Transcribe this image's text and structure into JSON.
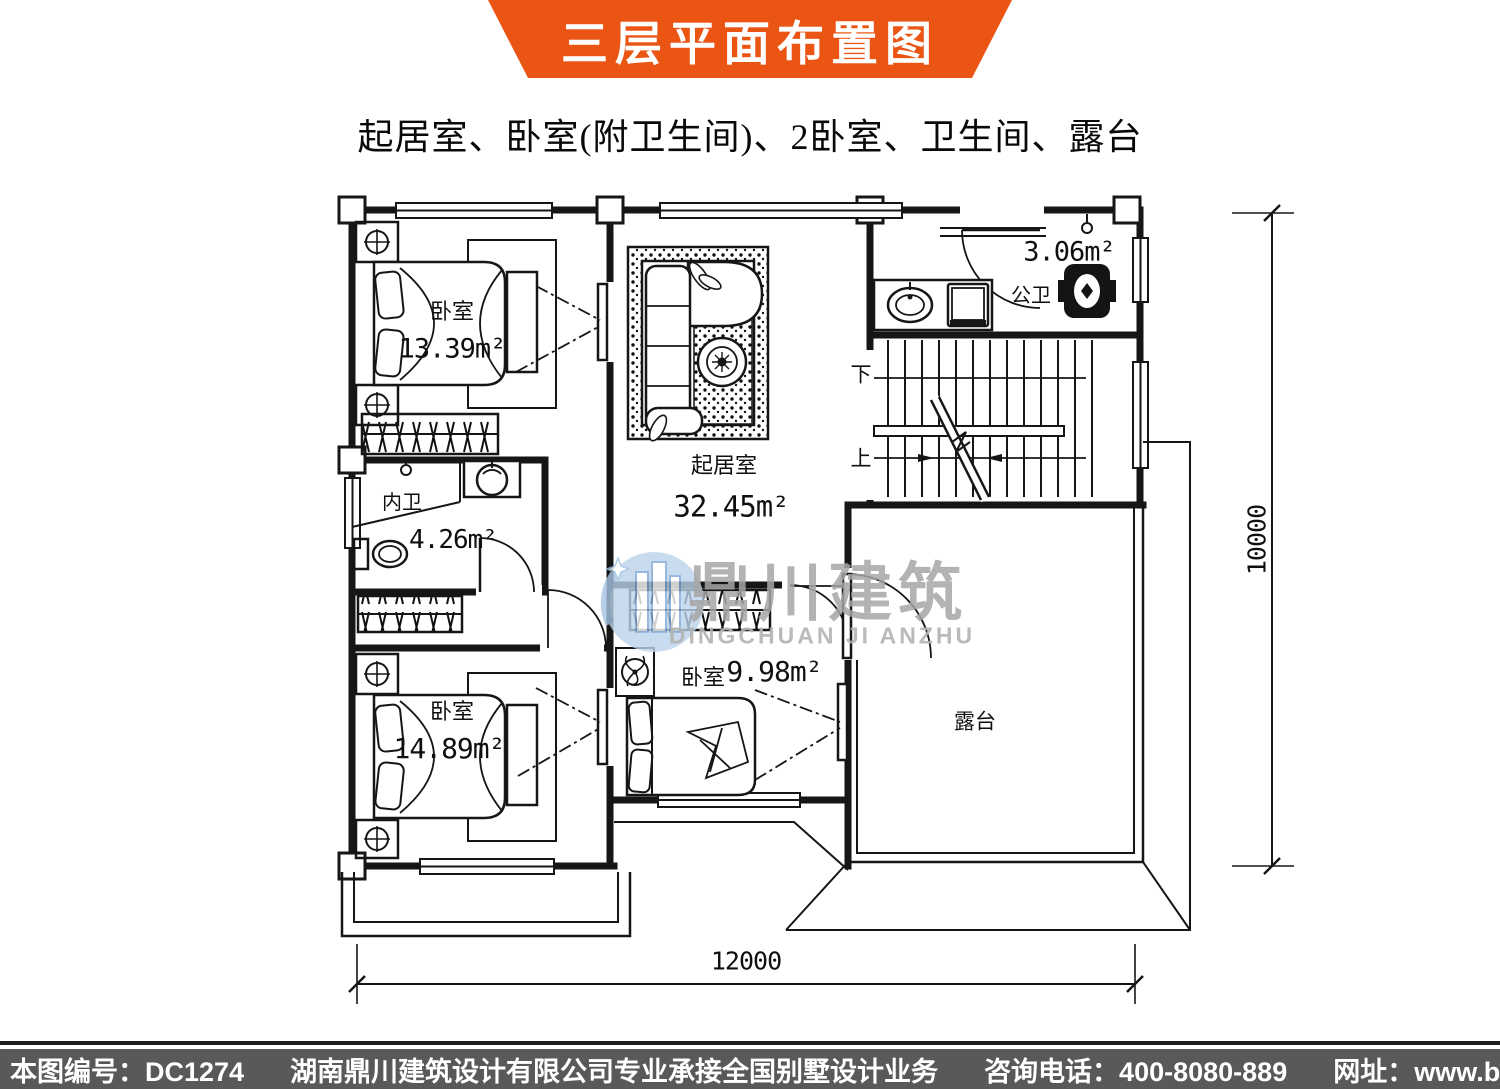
{
  "banner": {
    "title": "三层平面布置图",
    "bg_color": "#EA5514",
    "text_color": "#ffffff"
  },
  "subtitle": "起居室、卧室(附卫生间)、2卧室、卫生间、露台",
  "plan": {
    "rooms": [
      {
        "id": "bedroom-top-left",
        "name": "卧室",
        "area": "13.39m²"
      },
      {
        "id": "bath-public",
        "name": "公卫",
        "area": "3.06m²"
      },
      {
        "id": "living-room",
        "name": "起居室",
        "area": "32.45m²"
      },
      {
        "id": "bath-ensuite",
        "name": "内卫",
        "area": "4.26m²"
      },
      {
        "id": "bedroom-bottom-left",
        "name": "卧室",
        "area": "14.89m²"
      },
      {
        "id": "bedroom-middle",
        "name": "卧室",
        "area": "9.98m²"
      },
      {
        "id": "terrace",
        "name": "露台",
        "area": ""
      }
    ],
    "stairs": {
      "down": "下",
      "up": "上"
    },
    "dimensions": {
      "width": "12000",
      "height": "10000"
    }
  },
  "watermark": {
    "zh": "鼎川建筑",
    "en": "DINGCHUAN JI ANZHU",
    "logo_color": "#BCD3EA"
  },
  "footer": {
    "number_label": "本图编号：DC1274",
    "company": "湖南鼎川建筑设计有限公司专业承接全国别墅设计业务",
    "phone_label": "咨询电话：400-8080-889",
    "site_label": "网址：www.bstzcs.com",
    "bg_color": "#58595B"
  }
}
